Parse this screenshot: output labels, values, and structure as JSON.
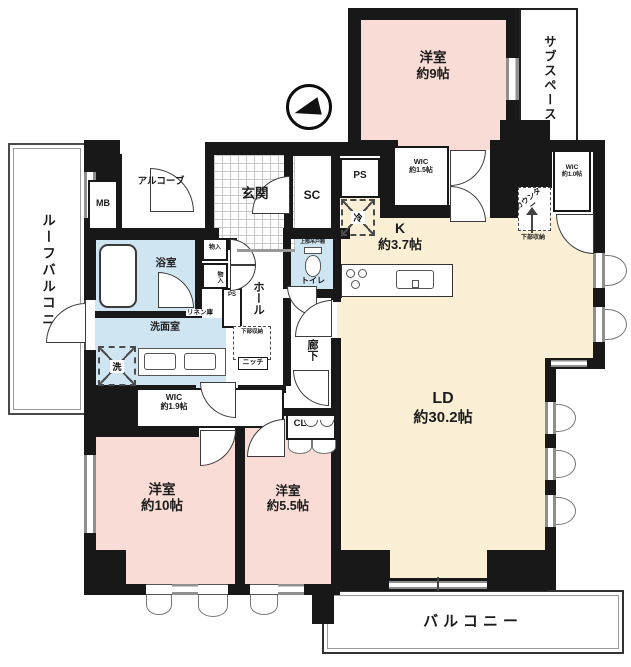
{
  "colors": {
    "wall": "#181818",
    "bedroom_pink": "#f9dcd6",
    "ldk_cream": "#fbf0d6",
    "wet_area_blue": "#cfe6f2",
    "window_gray": "#8f8f8f"
  },
  "labels": {
    "roof_balcony": "ルーフバルコニー",
    "sub_space": "サブスペース",
    "bedroom9_name": "洋室",
    "bedroom9_size": "約9帖",
    "wic15_name": "WIC",
    "wic15_size": "約1.5帖",
    "counter": "カウンター",
    "counter_lower_storage": "下部収納",
    "wic10_name": "WIC",
    "wic10_size": "約1.0帖",
    "mb": "MB",
    "alcove": "アルコーブ",
    "entrance": "玄関",
    "shoe_closet": "SC",
    "ps_top": "PS",
    "fridge": "冷",
    "kitchen_name": "K",
    "kitchen_size": "約3.7帖",
    "ld_name": "LD",
    "ld_size": "約30.2帖",
    "bath": "浴室",
    "storage_a": "物入",
    "storage_b": "物入",
    "hall": "ホール",
    "toilet": "トイレ",
    "toilet_upper_cabinet": "上部吊戸棚",
    "linen": "リネン庫",
    "ps_hall": "PS",
    "washroom": "洗面室",
    "washer": "洗",
    "hall_lower_storage": "下部収納",
    "niche": "ニッチ",
    "corridor": "廊下",
    "wic19_name": "WIC",
    "wic19_size": "約1.9帖",
    "closet": "CL",
    "bedroom10_name": "洋室",
    "bedroom10_size": "約10帖",
    "bedroom55_name": "洋室",
    "bedroom55_size": "約5.5帖",
    "balcony": "バルコニー"
  }
}
